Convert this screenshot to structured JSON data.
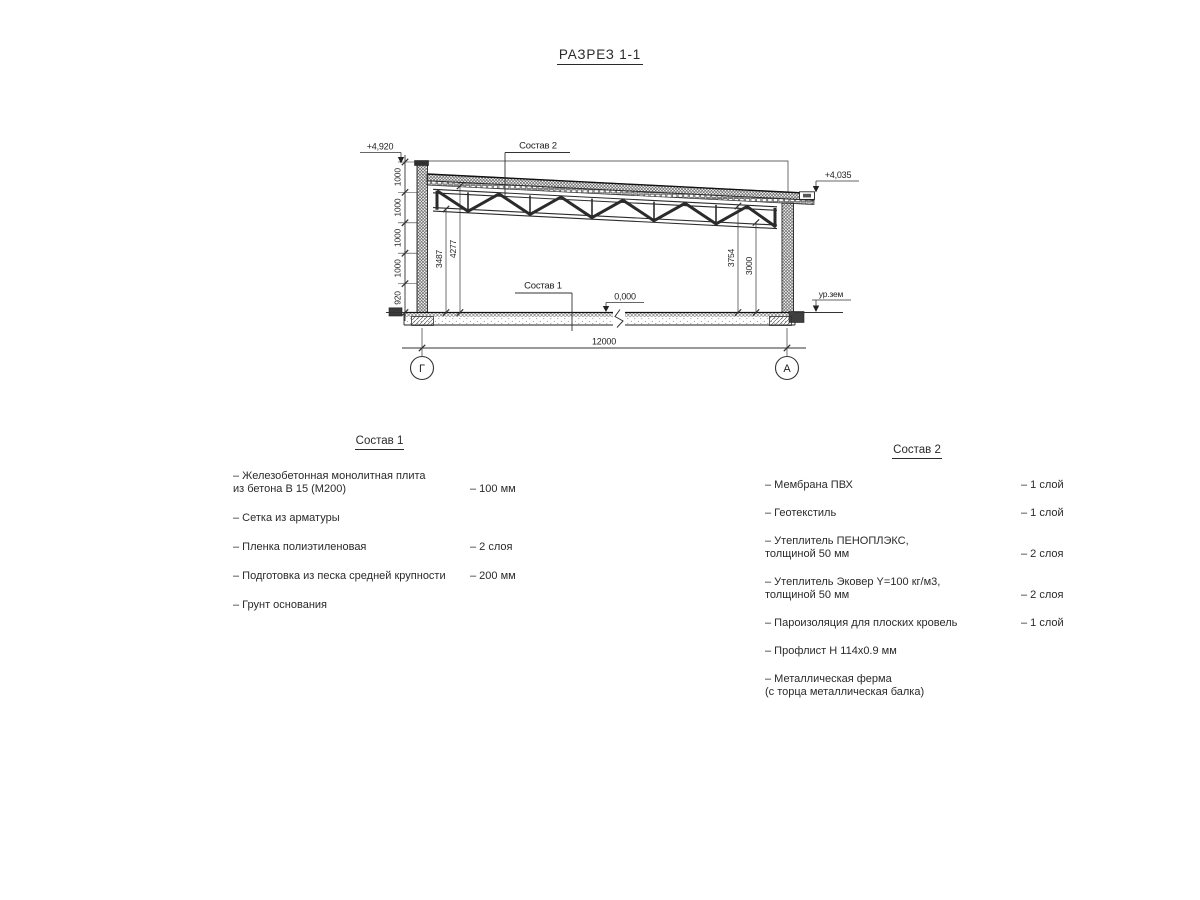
{
  "title": "РАЗРЕЗ 1-1",
  "section": {
    "elev_left_top": "+4,920",
    "elev_right_top": "+4,035",
    "elev_floor": "0,000",
    "ground_label": "ур.зем",
    "leader1": "Состав 1",
    "leader2": "Состав 2",
    "dim_span": "12000",
    "axis_left": "Г",
    "axis_right": "А",
    "chain": [
      "1000",
      "1000",
      "1000",
      "1000",
      "920"
    ],
    "dim_3487": "3487",
    "dim_4277": "4277",
    "dim_3754": "3754",
    "dim_3000": "3000"
  },
  "sostav1": {
    "heading": "Состав 1",
    "items": [
      {
        "name": "– Железобетонная  монолитная плита\nиз бетона В 15 (М200)",
        "value": "– 100 мм"
      },
      {
        "name": "– Сетка из арматуры",
        "value": ""
      },
      {
        "name": "– Пленка полиэтиленовая",
        "value": "– 2 слоя"
      },
      {
        "name": "– Подготовка из песка средней крупности",
        "value": "– 200 мм"
      },
      {
        "name": "– Грунт основания",
        "value": ""
      }
    ]
  },
  "sostav2": {
    "heading": "Состав 2",
    "items": [
      {
        "name": "– Мембрана ПВХ",
        "value": "– 1 слой"
      },
      {
        "name": "– Геотекстиль",
        "value": "– 1 слой"
      },
      {
        "name": "– Утеплитель ПЕНОПЛЭКС,\nтолщиной 50 мм",
        "value": "– 2 слоя"
      },
      {
        "name": "– Утеплитель Эковер Y=100 кг/м3,\nтолщиной 50 мм",
        "value": "– 2 слоя"
      },
      {
        "name": "– Пароизоляция для плоских кровель",
        "value": "– 1 слой"
      },
      {
        "name": "– Профлист Н 114х0.9 мм",
        "value": ""
      },
      {
        "name": "– Металлическая ферма\n(с торца металлическая балка)",
        "value": ""
      }
    ]
  }
}
